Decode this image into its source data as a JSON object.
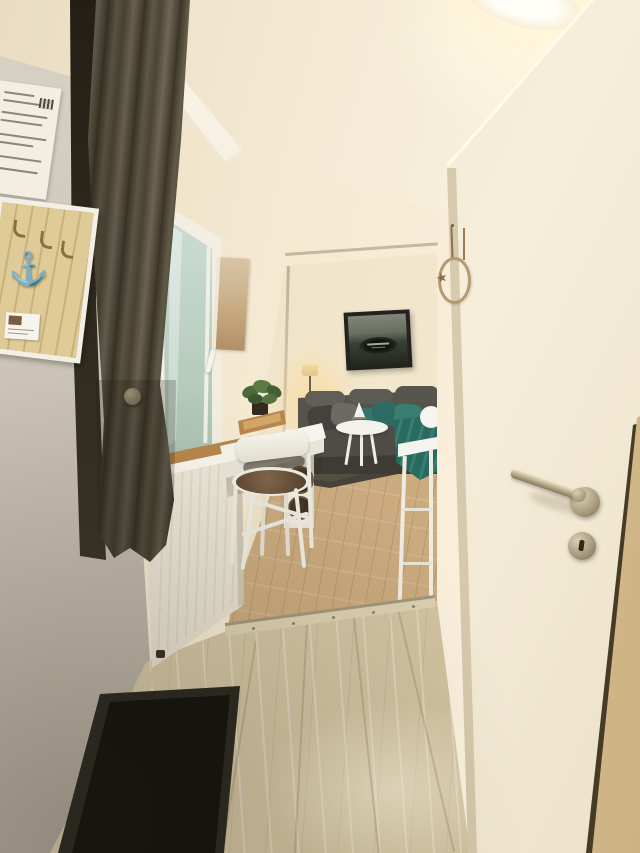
{
  "meta": {
    "type": "photograph",
    "subject": "Narrow apartment hallway with open white door, window with dark curtain, small white desk and folding chair, opening into a living room with gray corner sofa",
    "visible_text": "none (paper notice text on wall is illegible)"
  },
  "palette": {
    "ceiling_cream": "#f8efe0",
    "far_wall_cream": "#f4e9d2",
    "left_wall_gray": "#bcb4a5",
    "curtain_olive": "#5d5543",
    "door_white": "#f3ead6",
    "door_jamb_wood": "#d9c295",
    "hall_floor_wood": "#d6c8a8",
    "living_floor_wood": "#cbab7d",
    "window_sill_wood": "#b98a4e",
    "radiator_white": "#ece6d6",
    "sofa_gray": "#52504a",
    "pillow_teal": "#33776c",
    "rug_dark": "#46423a",
    "shoe_tray_black": "#15140f",
    "hardware_steel": "#a89b7d",
    "key_rack_wood": "#d8c28c"
  },
  "objects": {
    "info_sheet": {
      "label": "paper notice pinned to left wall"
    },
    "key_rack": {
      "label": "wooden key rack with hooks and white anchor ornament"
    },
    "curtain": {
      "label": "dark olive curtain gathered with button tieback"
    },
    "window": {
      "label": "white-framed window with garden view and handle"
    },
    "window_sill": {
      "label": "wooden window sill"
    },
    "radiator": {
      "label": "white panel radiator with thermostat valve"
    },
    "hall_art": {
      "label": "narrow beach-toned canvas print"
    },
    "desk": {
      "label": "small white desk with wooden tray and potted plant"
    },
    "chair": {
      "label": "white folding chair with round brown seat cushion"
    },
    "living_room": {
      "label": "living room with gray corner sofa, teal pillows and throw"
    },
    "boat_picture": {
      "label": "dark framed boat photograph above sofa"
    },
    "floor_lamp": {
      "label": "warm glowing floor lamp"
    },
    "side_table": {
      "label": "white round side table with sailboat ornament"
    },
    "rug": {
      "label": "dark gray area rug"
    },
    "sideboard": {
      "label": "white sideboard with round baskets"
    },
    "shelf_unit": {
      "label": "white open shelf table near door"
    },
    "transition_strip": {
      "label": "metal floor transition strip with screws"
    },
    "hall_floor": {
      "label": "whitewashed wood laminate hallway floor"
    },
    "shoe_tray": {
      "label": "black rubber shoe tray"
    },
    "door": {
      "label": "open white interior door"
    },
    "door_handle": {
      "label": "stainless lever door handle on round rosette"
    },
    "door_keyhole": {
      "label": "round keyhole escutcheon"
    },
    "door_jamb": {
      "label": "wooden door jamb"
    },
    "wall_decoration": {
      "label": "rope ring with starfish hanging from nail"
    },
    "ceiling_light": {
      "label": "glowing ceiling light fixture"
    }
  }
}
